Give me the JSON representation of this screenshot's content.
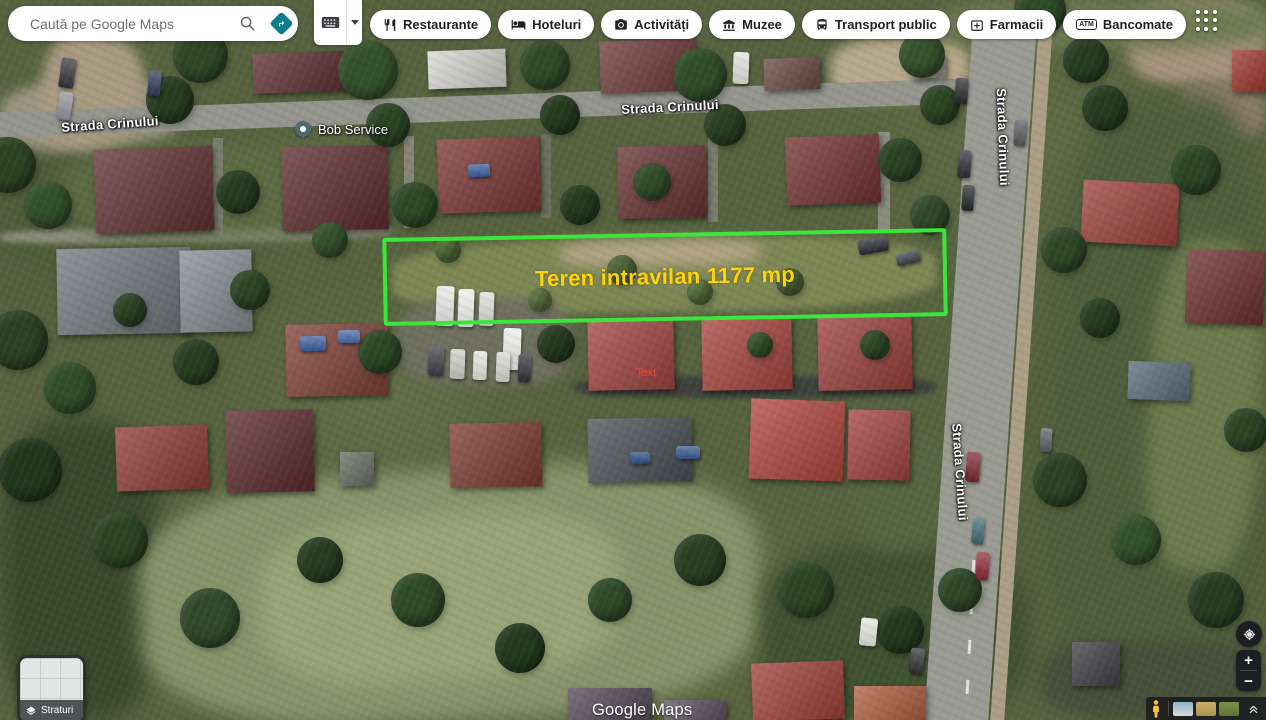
{
  "search": {
    "placeholder": "Caută pe Google Maps"
  },
  "toolbar_icons": {
    "search": "magnifier",
    "directions": "teal-diamond-arrow",
    "input_tools": "keyboard"
  },
  "chips": [
    {
      "label": "Restaurante",
      "icon": "restaurant-icon"
    },
    {
      "label": "Hoteluri",
      "icon": "hotel-icon"
    },
    {
      "label": "Activități",
      "icon": "camera-icon"
    },
    {
      "label": "Muzee",
      "icon": "museum-icon"
    },
    {
      "label": "Transport public",
      "icon": "bus-icon"
    },
    {
      "label": "Farmacii",
      "icon": "pharmacy-icon"
    },
    {
      "label": "Bancomate",
      "icon": "atm-icon",
      "icon_text": "ATM"
    }
  ],
  "map": {
    "street_labels": [
      {
        "text": "Strada Crinului"
      },
      {
        "text": "Strada Crinului"
      },
      {
        "text": "Strada Crinului"
      },
      {
        "text": "Strada Crinului"
      }
    ],
    "place": {
      "name": "Bob Service"
    },
    "plot": {
      "label": "Teren intravilan 1177 mp",
      "outline_color": "#3ce53c",
      "label_color": "#ffd400"
    },
    "annotation": {
      "text": "Text",
      "color": "#e8432e"
    },
    "watermark": "Google Maps"
  },
  "layers_button": {
    "label": "Straturi"
  },
  "zoom_controls": {
    "zoom_in": "+",
    "zoom_out": "−"
  },
  "colors": {
    "directions_accent": "#0d7d8a",
    "pegman": "#fbc02d",
    "control_bg": "#1d1e21"
  },
  "map_features": {
    "patches": [
      [
        0,
        80,
        180,
        70,
        "#9a9480",
        -3,
        6
      ],
      [
        40,
        35,
        100,
        115,
        "#a89a80",
        12,
        6
      ],
      [
        830,
        38,
        140,
        62,
        "#b7a98b",
        -2,
        6
      ],
      [
        1128,
        0,
        138,
        85,
        "#a6937c",
        0,
        6
      ],
      [
        1180,
        80,
        86,
        60,
        "#8a7c66",
        0,
        6
      ],
      [
        940,
        0,
        330,
        48,
        "#6e7a52",
        0,
        8
      ],
      [
        392,
        238,
        545,
        74,
        "#7f8755",
        -1,
        4
      ],
      [
        560,
        240,
        200,
        26,
        "#b2a483",
        -1,
        6
      ],
      [
        398,
        298,
        175,
        88,
        "#70705f",
        0,
        5
      ],
      [
        0,
        420,
        160,
        300,
        "#3a4a2d",
        0,
        10
      ],
      [
        140,
        470,
        620,
        250,
        "#87946a",
        -3,
        10
      ],
      [
        260,
        515,
        360,
        165,
        "#98a477",
        -4,
        9
      ],
      [
        760,
        545,
        270,
        175,
        "#415231",
        0,
        10
      ],
      [
        1046,
        95,
        220,
        625,
        "#4f5f3b",
        3,
        10
      ],
      [
        1150,
        240,
        110,
        330,
        "#6d7c4e",
        3,
        8
      ],
      [
        0,
        226,
        392,
        16,
        "#8b8d7c",
        -1,
        3
      ],
      [
        574,
        376,
        362,
        22,
        "#3e423c",
        0,
        3
      ],
      [
        1040,
        640,
        226,
        80,
        "#46503a",
        0,
        8
      ],
      [
        855,
        430,
        90,
        120,
        "#556540",
        0,
        8
      ],
      [
        60,
        140,
        330,
        95,
        "#5c6a42",
        -2,
        9
      ]
    ],
    "roads": [
      [
        -10,
        95,
        1000,
        25,
        "#94968e",
        -2
      ],
      [
        948,
        30,
        64,
        700,
        "#9a9c93",
        4
      ],
      [
        1014,
        30,
        14,
        700,
        "#ac9f86",
        4
      ],
      [
        213,
        138,
        10,
        96,
        "#7b7c6e",
        0
      ],
      [
        404,
        136,
        10,
        92,
        "#868779",
        0
      ],
      [
        541,
        134,
        10,
        84,
        "#6e6f5f",
        0
      ],
      [
        708,
        134,
        10,
        88,
        "#7b7c6e",
        0
      ],
      [
        878,
        132,
        12,
        98,
        "#8b8c80",
        0
      ],
      [
        972,
        560,
        3,
        14,
        "#e6e6e0",
        4
      ],
      [
        970,
        600,
        3,
        14,
        "#e6e6e0",
        4
      ],
      [
        968,
        640,
        3,
        14,
        "#e6e6e0",
        4
      ],
      [
        966,
        680,
        3,
        14,
        "#e6e6e0",
        4
      ]
    ],
    "houses": [
      [
        253,
        52,
        100,
        40,
        "#5d2d30",
        -2
      ],
      [
        428,
        50,
        78,
        38,
        "#d8d8d3",
        -2
      ],
      [
        600,
        40,
        96,
        52,
        "#6e3937",
        -2
      ],
      [
        764,
        58,
        56,
        32,
        "#6a4a44",
        -2
      ],
      [
        1232,
        50,
        34,
        42,
        "#a03a30",
        0
      ],
      [
        912,
        56,
        34,
        22,
        "#95978d",
        -2
      ],
      [
        95,
        148,
        118,
        84,
        "#603031",
        -2
      ],
      [
        282,
        146,
        106,
        84,
        "#5c2b2d",
        -1
      ],
      [
        438,
        138,
        102,
        74,
        "#7b3533",
        -2
      ],
      [
        618,
        146,
        88,
        72,
        "#683032",
        -1
      ],
      [
        786,
        136,
        94,
        68,
        "#723130",
        -2
      ],
      [
        1082,
        182,
        96,
        62,
        "#9d4139",
        3
      ],
      [
        1186,
        250,
        78,
        74,
        "#6c2f2d",
        2
      ],
      [
        57,
        248,
        134,
        86,
        "#70777d",
        -1
      ],
      [
        180,
        250,
        72,
        82,
        "#878e93",
        -1
      ],
      [
        286,
        324,
        102,
        72,
        "#7e4136",
        -1
      ],
      [
        588,
        318,
        86,
        72,
        "#a34440",
        -1
      ],
      [
        702,
        316,
        90,
        74,
        "#a8453e",
        -1
      ],
      [
        818,
        314,
        94,
        76,
        "#9d403b",
        -1
      ],
      [
        116,
        426,
        92,
        64,
        "#8e3b35",
        -2
      ],
      [
        226,
        410,
        88,
        82,
        "#5b292b",
        -1
      ],
      [
        450,
        423,
        92,
        64,
        "#7d3a32",
        -1
      ],
      [
        588,
        418,
        104,
        64,
        "#4b4f54",
        -1
      ],
      [
        750,
        400,
        94,
        80,
        "#b1453a",
        2
      ],
      [
        848,
        410,
        62,
        70,
        "#a24340",
        1
      ],
      [
        340,
        452,
        34,
        34,
        "#6b6f63",
        0
      ],
      [
        752,
        662,
        92,
        58,
        "#9e4138",
        -2
      ],
      [
        854,
        686,
        72,
        34,
        "#b06040",
        0
      ],
      [
        568,
        688,
        84,
        32,
        "#544b58",
        0
      ],
      [
        664,
        700,
        62,
        20,
        "#5e5260",
        0
      ],
      [
        1072,
        642,
        48,
        44,
        "#3f3f45",
        0
      ],
      [
        1128,
        362,
        62,
        38,
        "#5a6e7c",
        2
      ]
    ],
    "trees": [
      [
        200,
        55,
        55,
        "#2e4726"
      ],
      [
        170,
        100,
        48,
        "#263d20"
      ],
      [
        368,
        70,
        60,
        "#33512a"
      ],
      [
        388,
        125,
        44,
        "#2a4423"
      ],
      [
        545,
        65,
        50,
        "#2f4a27"
      ],
      [
        560,
        115,
        40,
        "#243b1e"
      ],
      [
        700,
        75,
        54,
        "#314d29"
      ],
      [
        725,
        125,
        42,
        "#283f21"
      ],
      [
        922,
        55,
        46,
        "#35522c"
      ],
      [
        940,
        105,
        40,
        "#2b4524"
      ],
      [
        1040,
        10,
        52,
        "#2f4a27"
      ],
      [
        1086,
        60,
        46,
        "#263d20"
      ],
      [
        8,
        165,
        56,
        "#2b4323"
      ],
      [
        48,
        205,
        48,
        "#32502a"
      ],
      [
        238,
        192,
        44,
        "#253c1f"
      ],
      [
        415,
        205,
        46,
        "#2d4825"
      ],
      [
        580,
        205,
        40,
        "#243a1e"
      ],
      [
        652,
        182,
        38,
        "#314d29"
      ],
      [
        900,
        160,
        44,
        "#2a4323"
      ],
      [
        930,
        215,
        40,
        "#30492a"
      ],
      [
        1105,
        108,
        46,
        "#253c1f"
      ],
      [
        1196,
        170,
        50,
        "#2c4524"
      ],
      [
        18,
        340,
        60,
        "#2a4122"
      ],
      [
        70,
        388,
        52,
        "#314d29"
      ],
      [
        196,
        362,
        46,
        "#263e20"
      ],
      [
        380,
        352,
        44,
        "#2c4724"
      ],
      [
        556,
        344,
        38,
        "#243a1e"
      ],
      [
        30,
        470,
        64,
        "#22371c"
      ],
      [
        120,
        540,
        56,
        "#2b4423"
      ],
      [
        210,
        618,
        60,
        "#30492a"
      ],
      [
        320,
        560,
        46,
        "#263d20"
      ],
      [
        418,
        600,
        54,
        "#2e4a26"
      ],
      [
        520,
        648,
        50,
        "#223a1d"
      ],
      [
        610,
        600,
        44,
        "#2f4a28"
      ],
      [
        700,
        560,
        52,
        "#283f21"
      ],
      [
        806,
        590,
        56,
        "#2c4524"
      ],
      [
        900,
        630,
        48,
        "#233a1d"
      ],
      [
        960,
        590,
        44,
        "#2f4827"
      ],
      [
        1060,
        480,
        54,
        "#2a4223"
      ],
      [
        1136,
        540,
        50,
        "#32502a"
      ],
      [
        1216,
        600,
        56,
        "#263d20"
      ],
      [
        1246,
        430,
        44,
        "#2b4423"
      ],
      [
        1064,
        250,
        46,
        "#2f4827"
      ],
      [
        1100,
        318,
        40,
        "#263d20"
      ],
      [
        622,
        270,
        30,
        "#4f6637"
      ],
      [
        700,
        292,
        26,
        "#57703c"
      ],
      [
        790,
        282,
        28,
        "#4a6234"
      ],
      [
        540,
        300,
        24,
        "#5a7340"
      ],
      [
        448,
        250,
        26,
        "#516b38"
      ],
      [
        250,
        290,
        40,
        "#2c4524"
      ],
      [
        330,
        240,
        36,
        "#34512b"
      ],
      [
        130,
        310,
        34,
        "#2a4223"
      ],
      [
        875,
        345,
        30,
        "#2e4826"
      ],
      [
        760,
        345,
        26,
        "#35522c"
      ]
    ],
    "cars": [
      [
        60,
        58,
        15,
        30,
        "#32343a",
        8
      ],
      [
        58,
        92,
        14,
        28,
        "#8f949b",
        8
      ],
      [
        148,
        70,
        13,
        26,
        "#2e3a55",
        5
      ],
      [
        733,
        52,
        16,
        32,
        "#e2e2dc",
        2
      ],
      [
        436,
        286,
        18,
        40,
        "#e8e8e4",
        2
      ],
      [
        458,
        289,
        16,
        38,
        "#f0f0ec",
        2
      ],
      [
        479,
        292,
        15,
        34,
        "#dcdcd6",
        2
      ],
      [
        503,
        328,
        18,
        42,
        "#eeeee8",
        2
      ],
      [
        428,
        346,
        16,
        30,
        "#3a3d42",
        2
      ],
      [
        450,
        349,
        15,
        30,
        "#caccc6",
        2
      ],
      [
        473,
        351,
        14,
        29,
        "#e4e4de",
        2
      ],
      [
        496,
        352,
        14,
        30,
        "#d6d8d2",
        2
      ],
      [
        518,
        354,
        13,
        28,
        "#2f3237",
        2
      ],
      [
        858,
        238,
        30,
        15,
        "#26292e",
        -10
      ],
      [
        896,
        252,
        24,
        12,
        "#3a3e44",
        -14
      ],
      [
        955,
        78,
        13,
        26,
        "#26282c",
        4
      ],
      [
        958,
        150,
        13,
        28,
        "#2b2d31",
        4
      ],
      [
        962,
        185,
        12,
        26,
        "#232528",
        4
      ],
      [
        1014,
        120,
        12,
        26,
        "#55585c",
        4
      ],
      [
        966,
        452,
        14,
        30,
        "#7c2430",
        4
      ],
      [
        972,
        518,
        12,
        26,
        "#3f6a74",
        4
      ],
      [
        976,
        552,
        13,
        28,
        "#8c2733",
        4
      ],
      [
        1040,
        428,
        12,
        24,
        "#5b5e63",
        4
      ],
      [
        860,
        618,
        17,
        28,
        "#e6e6e0",
        6
      ],
      [
        910,
        648,
        14,
        26,
        "#2e3034",
        6
      ],
      [
        300,
        336,
        26,
        15,
        "#3c5f9f",
        -1
      ],
      [
        338,
        330,
        22,
        13,
        "#466aa8",
        -1
      ],
      [
        468,
        164,
        22,
        13,
        "#3a5d9d",
        -2
      ],
      [
        676,
        446,
        24,
        13,
        "#35588f",
        0
      ],
      [
        630,
        452,
        20,
        12,
        "#2f4f86",
        0
      ]
    ]
  }
}
